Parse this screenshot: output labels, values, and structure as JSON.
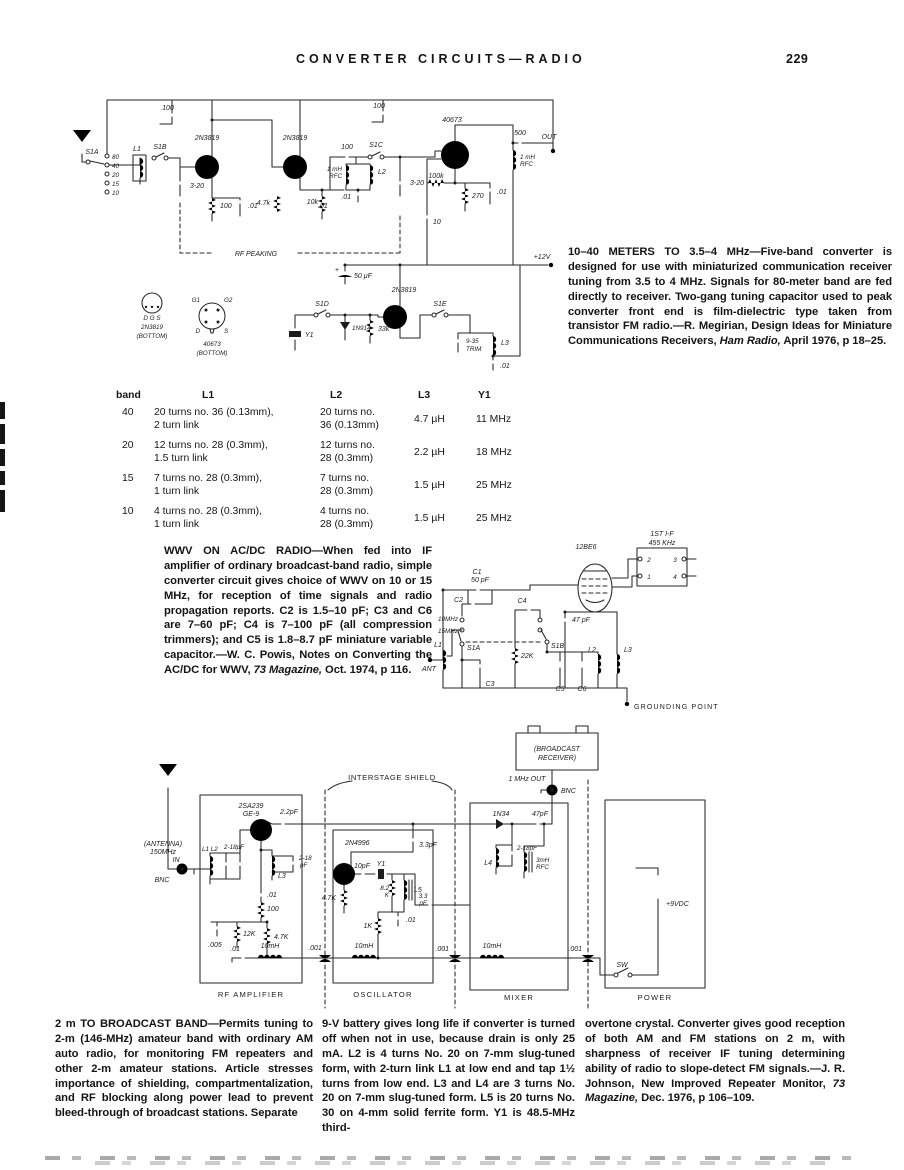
{
  "header": {
    "title": "CONVERTER CIRCUITS—RADIO",
    "page_number": "229"
  },
  "caption_10_40": {
    "part1": "10–40 METERS TO 3.5–4 MHz—Five-band converter is designed for use with miniaturized communication receiver tuning from 3.5 to 4 MHz. Signals for 80-meter band are fed directly to receiver. Two-gang tuning capacitor used to peak converter front end is film-dielectric type taken from transistor FM radio.—R. Megirian, Design Ideas for Miniature Communications Receivers, ",
    "italic": "Ham Radio,",
    "part2": " April 1976, p 18–25."
  },
  "caption_wwv": {
    "part1": "WWV ON AC/DC RADIO—When fed into IF amplifier of ordinary broadcast-band radio, simple converter circuit gives choice of WWV on 10 or 15 MHz, for reception of time signals and radio propagation reports. C2 is 1.5–10 pF; C3 and C6 are 7–60 pF; C4 is 7–100 pF (all compression trimmers); and C5 is 1.8–8.7 pF miniature variable capacitor.—W. C. Powis, Notes on Converting the AC/DC for WWV, ",
    "italic": "73 Magazine,",
    "part2": " Oct. 1974, p 116."
  },
  "caption_2m": {
    "col1": "2 m TO BROADCAST BAND—Permits tuning to 2-m (146-MHz) amateur band with ordinary AM auto radio, for monitoring FM repeaters and other 2-m amateur stations. Article stresses importance of shielding, compartmentalization, and RF blocking along power lead to prevent bleed-through of broadcast stations. Separate",
    "col2": "9-V battery gives long life if converter is turned off when not in use, because drain is only 25 mA. L2 is 4 turns No. 20 on 7-mm slug-tuned form, with 2-turn link L1 at low end and tap 1½ turns from low end. L3 and L4 are 3 turns No. 20 on 7-mm slug-tuned form. L5 is 20 turns No. 30 on 4-mm solid ferrite form. Y1 is 48.5-MHz third-",
    "col3_part1": "overtone crystal. Converter gives good reception of both AM and FM stations on 2 m, with sharpness of receiver IF tuning determining ability of radio to slope-detect FM signals.—J. R. Johnson, New Improved Repeater Monitor, ",
    "col3_italic": "73 Magazine,",
    "col3_part2": " Dec. 1976, p 106–109."
  },
  "coil_table": {
    "headers": [
      "band",
      "L1",
      "L2",
      "L3",
      "Y1"
    ],
    "rows": [
      {
        "band": "40",
        "l1a": "20 turns no. 36 (0.13mm),",
        "l1b": "2 turn link",
        "l2a": "20 turns no.",
        "l2b": "36 (0.13mm)",
        "l3": "4.7 µH",
        "y1": "11 MHz"
      },
      {
        "band": "20",
        "l1a": "12 turns no. 28 (0.3mm),",
        "l1b": "1.5 turn link",
        "l2a": "12 turns no.",
        "l2b": "28 (0.3mm)",
        "l3": "2.2 µH",
        "y1": "18 MHz"
      },
      {
        "band": "15",
        "l1a": "7 turns no. 28 (0.3mm),",
        "l1b": "1 turn link",
        "l2a": "7 turns no.",
        "l2b": "28 (0.3mm)",
        "l3": "1.5 µH",
        "y1": "25 MHz"
      },
      {
        "band": "10",
        "l1a": "4 turns no. 28 (0.3mm),",
        "l1b": "1 turn link",
        "l2a": "4 turns no.",
        "l2b": "28 (0.3mm)",
        "l3": "1.5 µH",
        "y1": "25 MHz"
      }
    ]
  },
  "s1": {
    "c100a": "100",
    "c100b": "100",
    "c100c": "100",
    "q1": "2N3819",
    "q2": "2N3819",
    "q3": "40673",
    "q4": "2N3819",
    "s1a": "S1A",
    "s1b": "S1B",
    "s1c": "S1C",
    "s1d": "S1D",
    "s1e": "S1E",
    "b80": "80",
    "b40": "40",
    "b20": "20",
    "b15": "15",
    "b10": "10",
    "l1": "L1",
    "l2": "L2",
    "l3": "L3",
    "var1": "3-20",
    "var2": "3-20",
    "r100": "100",
    "c01a": ".01",
    "r47k": "4.7k",
    "c01b": ".01",
    "r10k": "10k",
    "rfc1a": "1 mH",
    "rfc1b": "RFC",
    "c01c": ".01",
    "r100k": "100k",
    "r270": "270",
    "c01d": ".01",
    "c10": "10",
    "rfc2a": "1 mH",
    "rfc2b": "RFC",
    "c500": "500",
    "out": "OUT",
    "rfpeak": "RF PEAKING",
    "v12": "+12V",
    "plus": "+",
    "c50": "50 μF",
    "y1": "Y1",
    "d1": "1N914",
    "r33k": "33k",
    "trima": "9-35",
    "trimb": "TRIM",
    "c01e": ".01",
    "pin1dgs": "D G S",
    "pin1name": "2N3819",
    "pin1bot": "(BOTTOM)",
    "pin2g1": "G1",
    "pin2g2": "G2",
    "pin2d": "D",
    "pin2s": "S",
    "pin2name": "40673",
    "pin2bot": "(BOTTOM)"
  },
  "s2": {
    "ifa": "1ST I-F",
    "ifb": "455 KHz",
    "t1": "1",
    "t2": "2",
    "t3": "3",
    "t4": "4",
    "tube": "12BE6",
    "c1": "C1",
    "c1v": "50 pF",
    "c2": "C2",
    "c4": "C4",
    "c47": "47 pF",
    "f10": "10MHz",
    "f15": "15MHz",
    "s1a": "S1A",
    "s1b": "S1B",
    "r22k": "22K",
    "l1": "L1",
    "ant": "ANT",
    "c3": "C3",
    "c5": "C5",
    "c6": "C6",
    "l2": "L2",
    "l3": "L3",
    "gp": "GROUNDING POINT"
  },
  "s3": {
    "bca": "(BROADCAST",
    "bcb": "RECEIVER)",
    "shield": "INTERSTAGE SHIELD",
    "mout": "1 MHz OUT",
    "bnc1": "BNC",
    "anta": "(ANTENNA)",
    "antb": "150MHz",
    "antc": "IN",
    "bnc2": "BNC",
    "q1a": "2SA239",
    "q1b": "GE-9",
    "c22": "2.2pF",
    "l1l2": "L1 L2",
    "v1": "2-18pF",
    "v2a": "2-18",
    "v2b": "pF",
    "l3": "L3",
    "c01a": ".01",
    "r100": "100",
    "c005": ".005",
    "r12k": "12K",
    "r47ka": "4.7K",
    "c01b": ".01",
    "ch1": "10mH",
    "ft1": ".001",
    "rfamp": "RF AMPLIFIER",
    "q2": "2N4996",
    "c10": "10pF",
    "y1": "Y1",
    "c33a": "3.3pF",
    "r47kb": "4.7K",
    "r82a": "8.2",
    "r82b": "K",
    "l5": "L5",
    "c33ba": "3.3",
    "c33bb": "pF",
    "c01c": ".01",
    "r1k": "1K",
    "ch2": "10mH",
    "ft2": ".001",
    "osc": "OSCILLATOR",
    "d1": "1N34",
    "c47": "47pF",
    "v3": "2-18pF",
    "l4": "L4",
    "rfca": "3mH",
    "rfcb": "RFC",
    "ch3": "10mH",
    "mixer": "MIXER",
    "v9": "+9VDC",
    "sw": "SW",
    "ft3": ".001",
    "power": "POWER"
  }
}
